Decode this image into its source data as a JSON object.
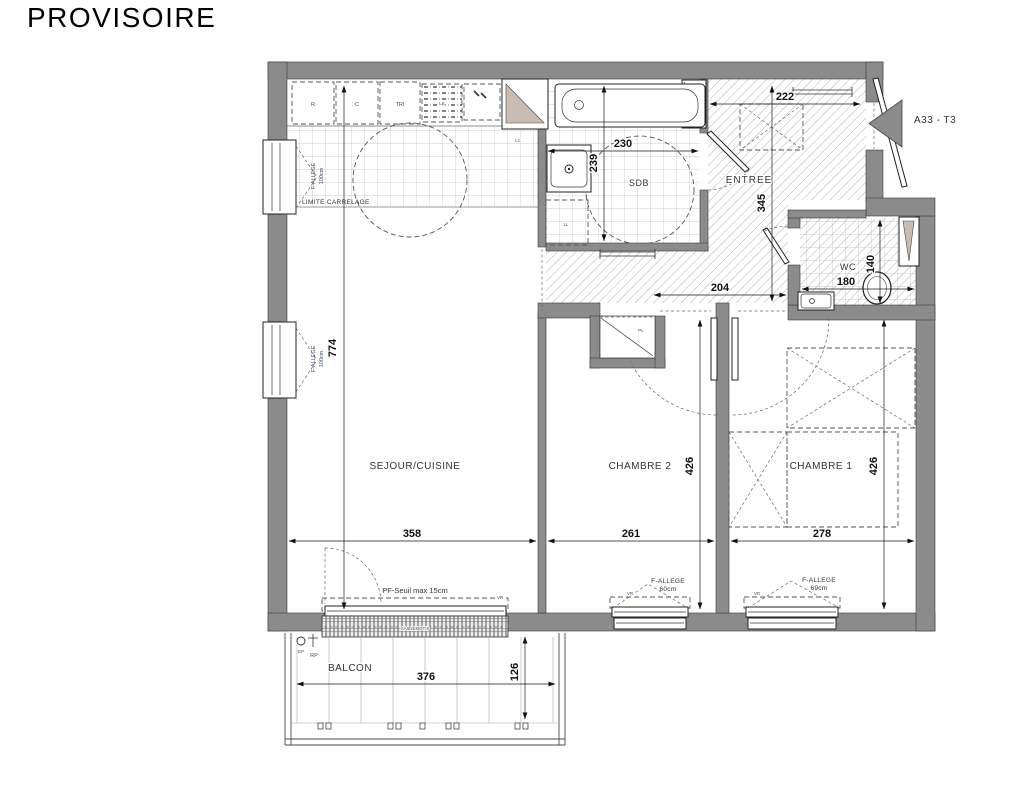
{
  "title": "PROVISOIRE",
  "unit_label": "A33 - T3",
  "rooms": {
    "sejour_cuisine": {
      "name": "SEJOUR/CUISINE",
      "width": "358",
      "height": "774"
    },
    "chambre2": {
      "name": "CHAMBRE 2",
      "width": "261",
      "height": "426"
    },
    "chambre1": {
      "name": "CHAMBRE 1",
      "width": "278",
      "height": "426"
    },
    "sdb": {
      "name": "SDB",
      "width": "230",
      "height": "239"
    },
    "wc": {
      "name": "WC",
      "width": "180",
      "height": "140"
    },
    "entree": {
      "name": "ENTREE",
      "width": "222",
      "height": "345"
    },
    "couloir": {
      "width": "204"
    },
    "balcon": {
      "name": "BALCON",
      "width": "376",
      "depth": "126"
    }
  },
  "windows": {
    "left_upper": {
      "type": "F-ALLEGE",
      "height": "100cm"
    },
    "left_lower": {
      "type": "F-ALLEGE",
      "height": "100cm"
    },
    "sejour_bay": {
      "note": "PF-Seuil max 15cm",
      "shutter": "VR",
      "grating": "CAILLEBOTIS"
    },
    "chambre2": {
      "type": "F-ALLEGE",
      "height": "60cm",
      "shutter": "VR"
    },
    "chambre1": {
      "type": "F-ALLEGE",
      "height": "69cm",
      "shutter": "VR"
    }
  },
  "kitchen": {
    "limit_note": "LIMITE CARRELAGE",
    "appliances": [
      "R",
      "C",
      "TRI",
      "LE"
    ],
    "duct": "LC"
  },
  "fixtures": {
    "washing_machine": "LL",
    "closet": "PL"
  },
  "balcony_marks": {
    "ep": "EP",
    "rp": "RP"
  },
  "colors": {
    "wall": "#8b8b8b",
    "shutter_fill": "#c9bcb2",
    "hatch": "#9c9c9c",
    "tile": "#bdbdbd",
    "dim_text": "#101010"
  }
}
